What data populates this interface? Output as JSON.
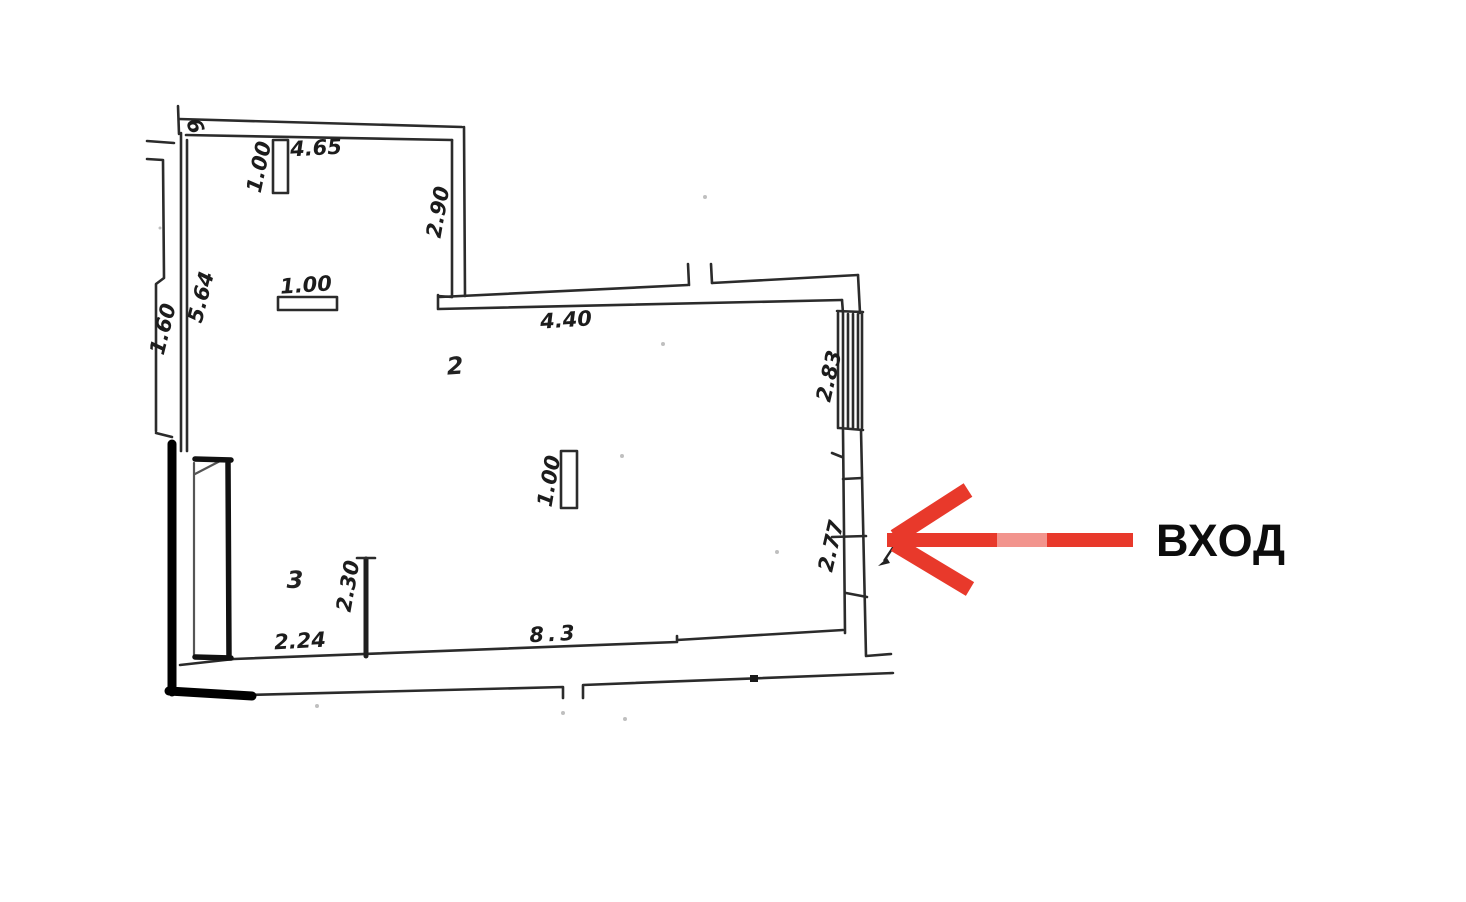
{
  "plan": {
    "ink_color": "#2b2b2b",
    "thick_wall_color": "#000000",
    "room_numbers": [
      {
        "name": "room-2",
        "label": "2"
      },
      {
        "name": "room-3",
        "label": "3"
      }
    ],
    "dimensions": [
      {
        "name": "top-niche-width",
        "label": "1.00"
      },
      {
        "name": "top-wall-length",
        "label": "4.65"
      },
      {
        "name": "right-jog-depth",
        "label": "2.90"
      },
      {
        "name": "left-window-width",
        "label": "1.00"
      },
      {
        "name": "left-wall-length",
        "label": "5.64"
      },
      {
        "name": "outer-offset-length",
        "label": "1.60"
      },
      {
        "name": "upper-wall-length",
        "label": "4.40"
      },
      {
        "name": "right-window-height",
        "label": "2.83"
      },
      {
        "name": "center-window-width",
        "label": "1.00"
      },
      {
        "name": "entrance-opening",
        "label": "2.77"
      },
      {
        "name": "partition-length",
        "label": "2.30"
      },
      {
        "name": "bottom-left-width",
        "label": "2.24"
      },
      {
        "name": "bottom-wall-length",
        "label": "8.3"
      },
      {
        "name": "corner-mark",
        "label": "6"
      }
    ]
  },
  "annotation": {
    "entrance_label": "ВХОД",
    "arrow_color": "#e8392b",
    "arrow_highlight_color": "#f2948d",
    "text_color": "#0d0d0d"
  }
}
